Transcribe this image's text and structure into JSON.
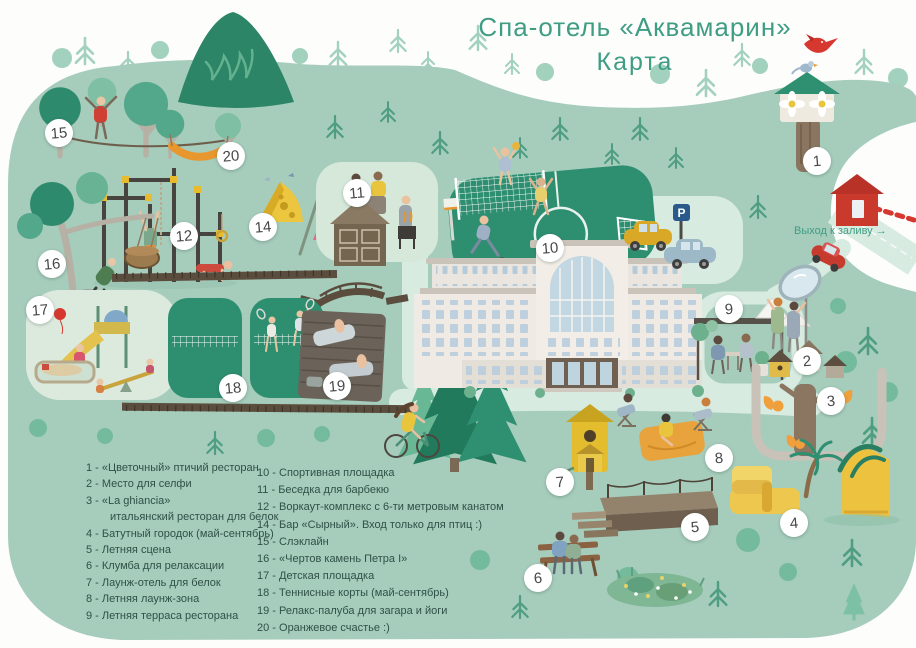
{
  "title": {
    "line1": "Спа-отель «Аквамарин»",
    "line2": "Карта"
  },
  "exit_sign": {
    "label": "Выход к заливу →"
  },
  "parking_sign": {
    "label": "P"
  },
  "map": {
    "markers": {
      "n1": "1",
      "n2": "2",
      "n3": "3",
      "n4": "4",
      "n5": "5",
      "n6": "6",
      "n7": "7",
      "n8": "8",
      "n9": "9",
      "n10": "10",
      "n11": "11",
      "n12": "12",
      "n14": "14",
      "n15": "15",
      "n16": "16",
      "n17": "17",
      "n18": "18",
      "n19": "19",
      "n20": "20"
    }
  },
  "legend": {
    "column1": [
      {
        "line": "1 - «Цветочный» птичий ресторан",
        "line2": ""
      },
      {
        "line": "2 - Место для селфи",
        "line2": ""
      },
      {
        "line": "3 - «La ghiancia»",
        "line2": "итальянский ресторан для белок"
      },
      {
        "line": "4 - Батутный городок (май-сентябрь)",
        "line2": ""
      },
      {
        "line": "5 - Летняя сцена",
        "line2": ""
      },
      {
        "line": "6 - Клумба для релаксации",
        "line2": ""
      },
      {
        "line": "7 - Лаунж-отель для белок",
        "line2": ""
      },
      {
        "line": "8 - Летняя лаунж-зона",
        "line2": ""
      },
      {
        "line": "9 - Летняя терраса ресторана",
        "line2": ""
      }
    ],
    "column2": [
      {
        "line": "10 - Спортивная площадка",
        "line2": ""
      },
      {
        "line": "11 - Беседка для барбекю",
        "line2": ""
      },
      {
        "line": "12 - Воркаут-комплекс с 6-ти метровым канатом",
        "line2": ""
      },
      {
        "line": "14 - Бар «Сырный». Вход только для птиц :)",
        "line2": ""
      },
      {
        "line": "15 - Слэклайн",
        "line2": ""
      },
      {
        "line": "16 - «Чертов камень Петра I»",
        "line2": ""
      },
      {
        "line": "17 - Детская площадка",
        "line2": ""
      },
      {
        "line": "18 - Теннисные корты (май-сентябрь)",
        "line2": ""
      },
      {
        "line": "19 - Релакс-палуба для загара и йоги",
        "line2": ""
      },
      {
        "line": "20 - Оранжевое счастье :)",
        "line2": ""
      }
    ]
  },
  "colors": {
    "map_green": "#a6ccbc",
    "title_teal": "#3f9d84",
    "legend_text": "#2f5147",
    "field_green": "#2e8e70",
    "wood_brown": "#5b4d3d",
    "accent_yellow": "#eac63e",
    "accent_orange": "#e8972f",
    "accent_red": "#d6382f",
    "parking_sign_blue": "#2a5a8c",
    "road_light": "#d8ebe0"
  }
}
